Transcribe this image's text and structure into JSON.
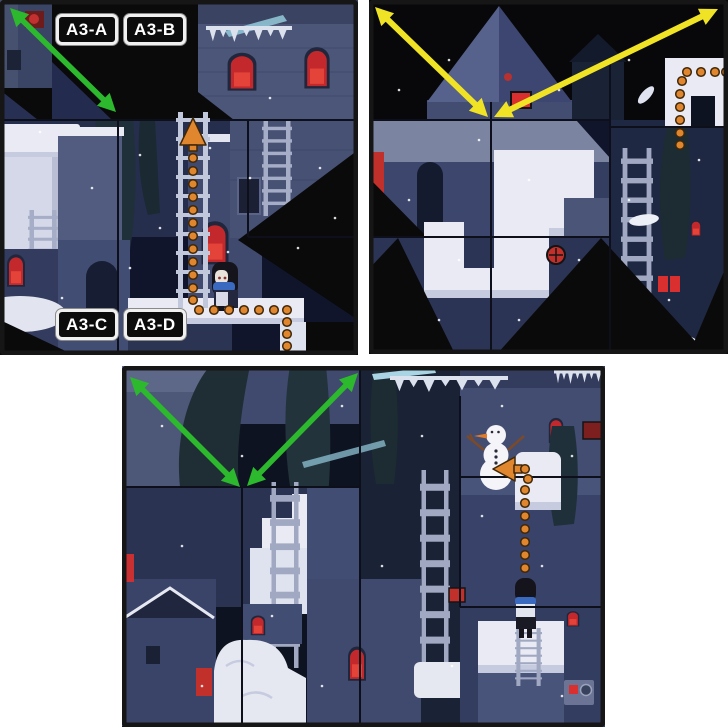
{
  "labels": {
    "tile_a": "A3-A",
    "tile_b": "A3-B",
    "tile_c": "A3-C",
    "tile_d": "A3-D"
  },
  "panels": {
    "top_left": {
      "name": "puzzle-board-A3-labeled"
    },
    "top_right": {
      "name": "puzzle-board-swap-preview"
    },
    "bottom": {
      "name": "puzzle-board-result"
    }
  },
  "colors": {
    "swap_arrow_green": "#2db92d",
    "swap_arrow_yellow": "#f0e325",
    "path_orange": "#e0862f",
    "label_background": "#0c0c0c",
    "label_border": "#f0f0f0",
    "label_text": "#ffffff",
    "page_background": "#ffffff",
    "snow": "#e9eaf4",
    "night_sky": "#10152b",
    "void_black": "#0a0a0b",
    "window_red": "#d9302f"
  }
}
